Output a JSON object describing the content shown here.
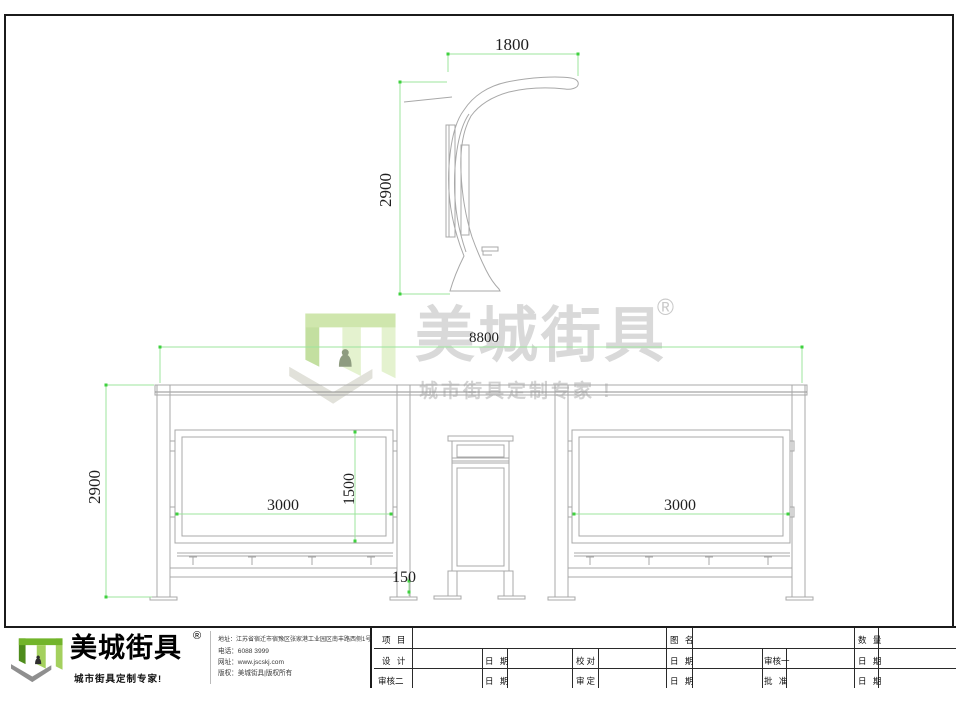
{
  "dimensions": {
    "side_view": {
      "width_mm": "1800",
      "height_mm": "2900"
    },
    "front_view": {
      "overall_width_mm": "8800",
      "overall_height_mm": "2900",
      "left_panel_width_mm": "3000",
      "right_panel_width_mm": "3000",
      "panel_height_mm": "1500",
      "rail_ground_gap_mm": "150"
    }
  },
  "watermark": {
    "brand": "美城街具",
    "registered_mark": "®",
    "tagline": "城市街具定制专家 !"
  },
  "logo_block": {
    "brand": "美城街具",
    "registered_mark": "®",
    "tagline": "城市街具定制专家!",
    "address": "地址：江苏省宿迁市宿豫区张家港工业园区南丰路西侧1号",
    "phone": "电话：6088 3999",
    "website": "网址：www.jscskj.com",
    "copyright": "版权：美城街具|版权所有"
  },
  "title_block": {
    "project_label": "项 目",
    "drawing_name_label": "图 名",
    "quantity_label": "数 量",
    "design_label": "设 计",
    "proofread_label": "校对",
    "reviewer1_label": "审核一",
    "reviewer2_label": "审核二",
    "approver_label": "审定",
    "ratify_label": "批 准",
    "date_label": "日 期"
  },
  "colors": {
    "dimension_line": "#9ce49c",
    "dimension_tick": "#3fd13f",
    "drawing_line": "#a8a8a8",
    "brand_green": "#72b42a"
  }
}
